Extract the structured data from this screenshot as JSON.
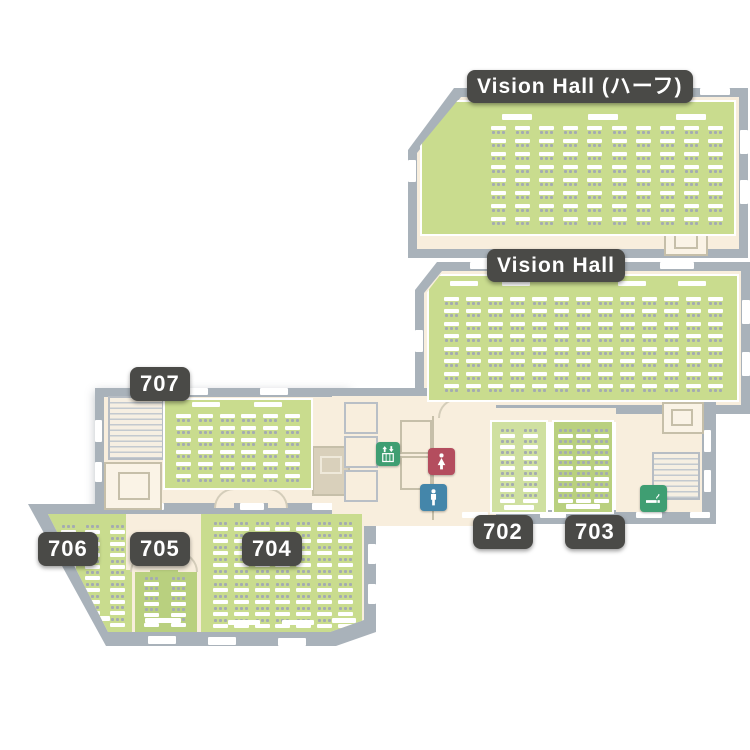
{
  "rooms": [
    {
      "id": "vision-hall-half",
      "label": "Vision Hall (ハーフ)",
      "seats": {
        "cols": 10,
        "rows": 8,
        "chairs": "below"
      }
    },
    {
      "id": "vision-hall",
      "label": "Vision Hall",
      "seats": {
        "cols": 13,
        "rows": 8,
        "chairs": "below"
      }
    },
    {
      "id": "707",
      "label": "707",
      "seats": {
        "cols": 6,
        "rows": 6,
        "chairs": "below"
      }
    },
    {
      "id": "702",
      "label": "702",
      "seats": {
        "cols": 2,
        "rows": 7,
        "chairs": "above"
      }
    },
    {
      "id": "703",
      "label": "703",
      "seats": {
        "cols": 3,
        "rows": 7,
        "chairs": "above"
      }
    },
    {
      "id": "704",
      "label": "704",
      "seats": {
        "cols": 7,
        "rows": 9,
        "chairs": "above"
      }
    },
    {
      "id": "705",
      "label": "705",
      "seats": {
        "cols": 2,
        "rows": 5,
        "chairs": "above"
      }
    },
    {
      "id": "706",
      "label": "706",
      "seats": {
        "cols": 3,
        "rows": 9,
        "chairs": "above"
      }
    }
  ],
  "icons": {
    "elevator": "elevator-icon",
    "toilet_women": "womens-toilet-icon",
    "toilet_men": "mens-toilet-icon",
    "smoking": "smoking-area-icon"
  },
  "colors": {
    "wall": "#a9b2ba",
    "corridor": "#f8eedd",
    "room_green": "#c9dc8e",
    "room_green_dark": "#b9d07f",
    "room_green_light": "#cfe0a0",
    "tan_room": "#d9d0bb",
    "label_bg": "#4a4a47",
    "icon_green": "#3f9e72",
    "toilet_women": "#b44d5e",
    "toilet_men": "#4486aa",
    "chair": "#a4abb1",
    "table": "#ffffff"
  }
}
